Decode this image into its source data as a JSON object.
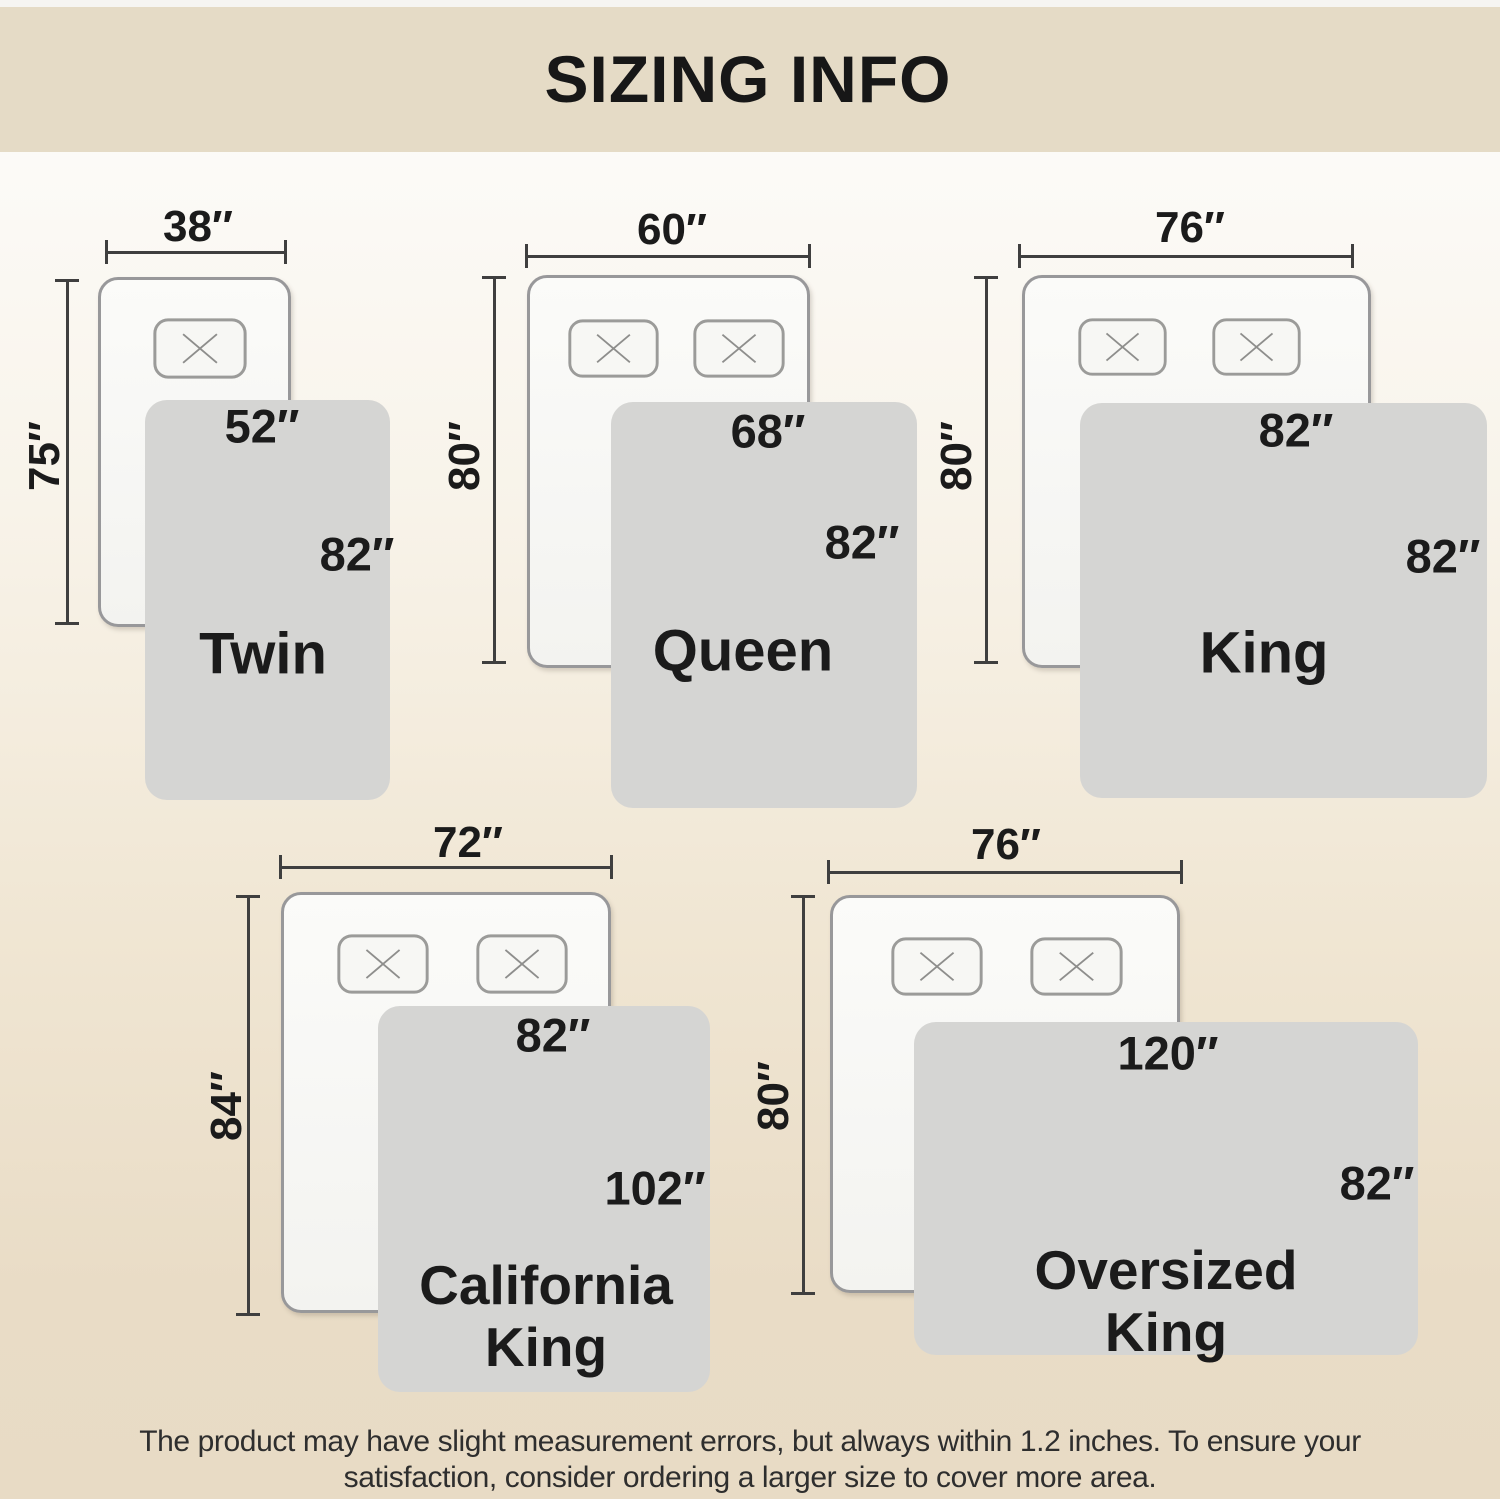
{
  "title": "SIZING INFO",
  "footer": {
    "line1": "The product may have slight measurement errors, but always within 1.2 inches. To ensure your",
    "line2": "satisfaction, consider ordering a larger size to cover more area."
  },
  "diagrams": [
    {
      "id": "twin",
      "name_line1": "Twin",
      "bed_width": "38″",
      "bed_length": "75″",
      "blanket_width": "52″",
      "blanket_length": "82″",
      "pillow_count": 1
    },
    {
      "id": "queen",
      "name_line1": "Queen",
      "bed_width": "60″",
      "bed_length": "80″",
      "blanket_width": "68″",
      "blanket_length": "82″",
      "pillow_count": 2
    },
    {
      "id": "king",
      "name_line1": "King",
      "bed_width": "76″",
      "bed_length": "80″",
      "blanket_width": "82″",
      "blanket_length": "82″",
      "pillow_count": 2
    },
    {
      "id": "california-king",
      "name_line1": "California",
      "name_line2": "King",
      "bed_width": "72″",
      "bed_length": "84″",
      "blanket_width": "82″",
      "blanket_length": "102″",
      "pillow_count": 2
    },
    {
      "id": "oversized-king",
      "name_line1": "Oversized",
      "name_line2": "King",
      "bed_width": "76″",
      "bed_length": "80″",
      "blanket_width": "120″",
      "blanket_length": "82″",
      "pillow_count": 2
    }
  ],
  "colors": {
    "banner": "#e5dbc6",
    "background_top": "#fcfbf8",
    "background_bottom": "#e8dbc5",
    "blanket": "#d5d5d3",
    "bed_fill": "#f9f9f7",
    "outline_gray": "#98989a",
    "dimension_line": "#3f3f3f",
    "text": "#1b1b1b"
  }
}
